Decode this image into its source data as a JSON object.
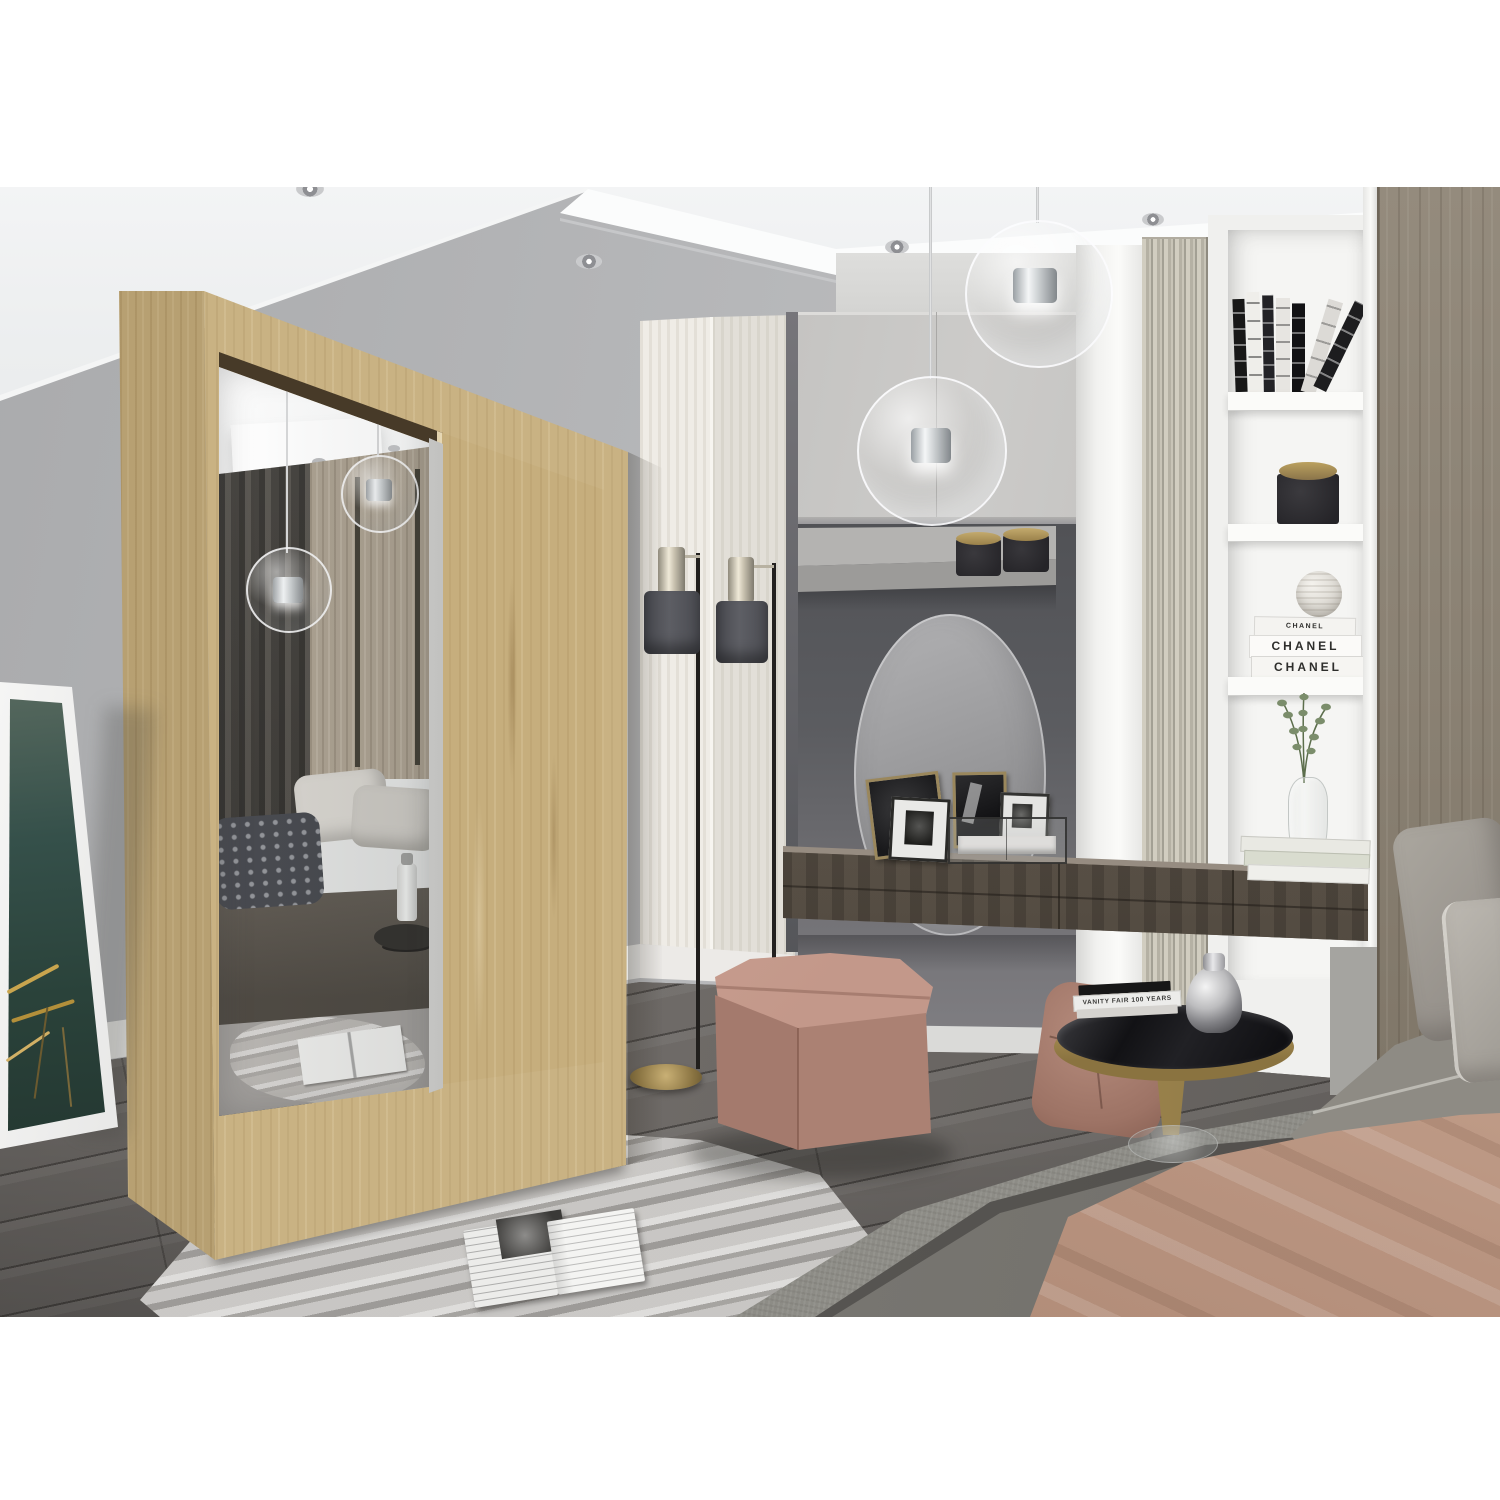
{
  "image": {
    "kind": "natural-photo",
    "scene": "Modern bedroom interior: sonoma-oak sliding-door wardrobe with mirror door reflecting the bed, vanity alcove with round mirror and floating console, ribbed slat panel, white bookshelf niche, glass globe pendant lamps, floor lamps, bed with gray bedding and blush throw, pink cube pouf, marble-pattern rug on dark plank floor",
    "canvas": {
      "width": 1500,
      "height": 1500
    },
    "photo_band": {
      "top": 187,
      "height": 1130
    }
  },
  "palette": {
    "white_margin": "#ffffff",
    "ceiling": "#eef0f1",
    "wall_left": "#b3b4b6",
    "oak_light": "#c9b283",
    "oak_shadow": "#b7a072",
    "alcove_dark": "#55565a",
    "cabinet_gray": "#c9c8c6",
    "console_wood": "#675e54",
    "slat_beige": "#c3bfb2",
    "bookshelf_white": "#f3f3f1",
    "right_panel_wood": "#8d8476",
    "floor_wood": "#666360",
    "rug_gray": "#b5b3b0",
    "pouf_pink": "#bd9183",
    "throw_pink": "#c5a28e",
    "bed_gray": "#8d8c86",
    "lamp_shade": "#54555b",
    "brass": "#a08b55"
  },
  "texts": {
    "chanel_book_thin": "CHANEL",
    "chanel_book_middle": "CHANEL",
    "chanel_book_bottom": "CHANEL",
    "vanity_fair_spine": "VANITY FAIR 100 YEARS"
  },
  "objects": [
    "ceiling spotlights",
    "glass globe pendant lights",
    "sliding-door wardrobe with mirror door",
    "mirror reflection: dark curtains, wood wall panels, bed, knit pillow, side table, rug, magazine",
    "two floor lamps",
    "leaning framed botanical print",
    "vanity alcove with round mirror",
    "two candle jars on shelf",
    "picture frames on console",
    "glass trinket box",
    "floating dark-wood console",
    "white pilaster",
    "ribbed slat panel",
    "bookshelf niche: leaning books, candle, striped sphere, CHANEL books, eucalyptus vase, stacked books",
    "tall wood wardrobe panel",
    "bed with gray bedding, pillows and blush throw",
    "round side table with VANITY FAIR books and silver vase",
    "blush leather pouf chair",
    "pink cube pouf",
    "marble-pattern rug",
    "open magazine",
    "dark diagonal plank floor"
  ]
}
